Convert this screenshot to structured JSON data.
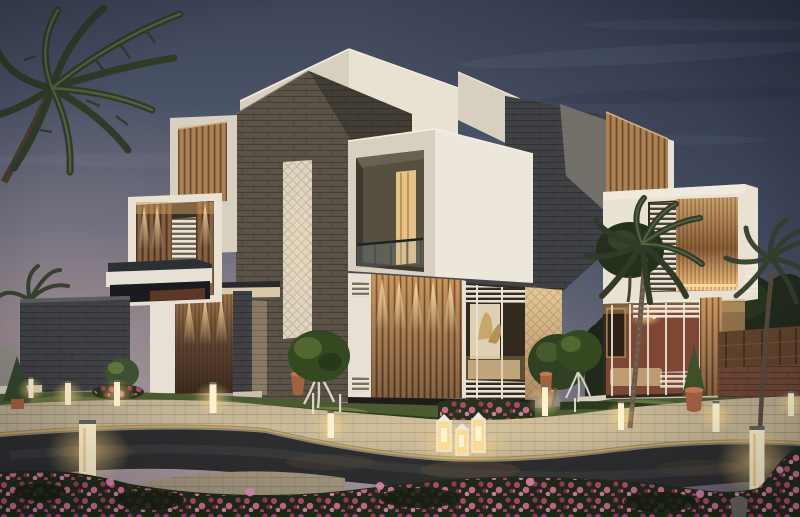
{
  "meta": {
    "title": "Luxury modern villa exterior at dusk — 3D architectural rendering",
    "scene_type": "photorealistic architectural visualization",
    "time_of_day": "dusk"
  },
  "scene": {
    "building": {
      "style": "contemporary two-storey villa with stacked cubic volumes",
      "materials": [
        "dark slate stone cladding",
        "cream limestone volumes",
        "vertical timber slat screens",
        "glass walls with white horizontal louvers"
      ],
      "features": [
        "chamfered stone tower",
        "recessed balcony with glass railing",
        "warm-lit timber entrance wall",
        "interior artwork visible through glazing"
      ]
    },
    "landscape": {
      "road": "curved asphalt street with yellow curb line",
      "sidewalk": "curved beige stone-paver promenade and corner plaza",
      "foreground": "dense magenta flower beds",
      "trees": [
        "palm trees",
        "round topiary on white trunk",
        "conical cypress in terracotta pots",
        "dark background tree mass"
      ]
    },
    "lighting": {
      "bollard_lights": 11,
      "candle_lanterns": 3,
      "downlight_washes": "warm accent downlights washing timber panels",
      "interior": "warm interior glow with brick feature wall and sconces"
    },
    "vegetation_counts": {
      "palm_trees": 5,
      "topiary_balls": 3,
      "conical_trees": 2,
      "terracotta_pots": 4
    }
  },
  "colors": {
    "sky_top": "#3d4458",
    "sky_mid": "#5a6479",
    "sky_low": "#7e7f8e",
    "sky_horizon": "#9c939b",
    "cream_lit": "#e9e2d3",
    "cream_shade": "#d7cfbf",
    "white_trim": "#e6e1d4",
    "stone_dark": "#3f4145",
    "stone_brown": "#5b5348",
    "stone_light_face": "#7d7870",
    "wood_light": "#c59a63",
    "wood_mid": "#9c7144",
    "wood_dark": "#6e4c2f",
    "door_wood": "#5e4431",
    "glass_dark": "#32291f",
    "glow_warm": "#ffdf9f",
    "glow_core": "#fff4d4",
    "interior_brick": "#8c4c38",
    "grass": "#4b5a31",
    "grass_lit": "#7e8a49",
    "hedge": "#2a3a1e",
    "flower_magenta": "#c24a7c",
    "flower_pink": "#e08bb0",
    "flower_foliage": "#26331a",
    "paver": "#bcae92",
    "paver_lit": "#d9caa9",
    "paver_fore": "#a2957d",
    "road": "#2c2d2f",
    "curb_yellow": "#c9a850",
    "terracotta": "#a4613f",
    "palm_dark": "#2f3a27",
    "palm_lit": "#5c6a45",
    "fence_wood": "#5f422c"
  }
}
